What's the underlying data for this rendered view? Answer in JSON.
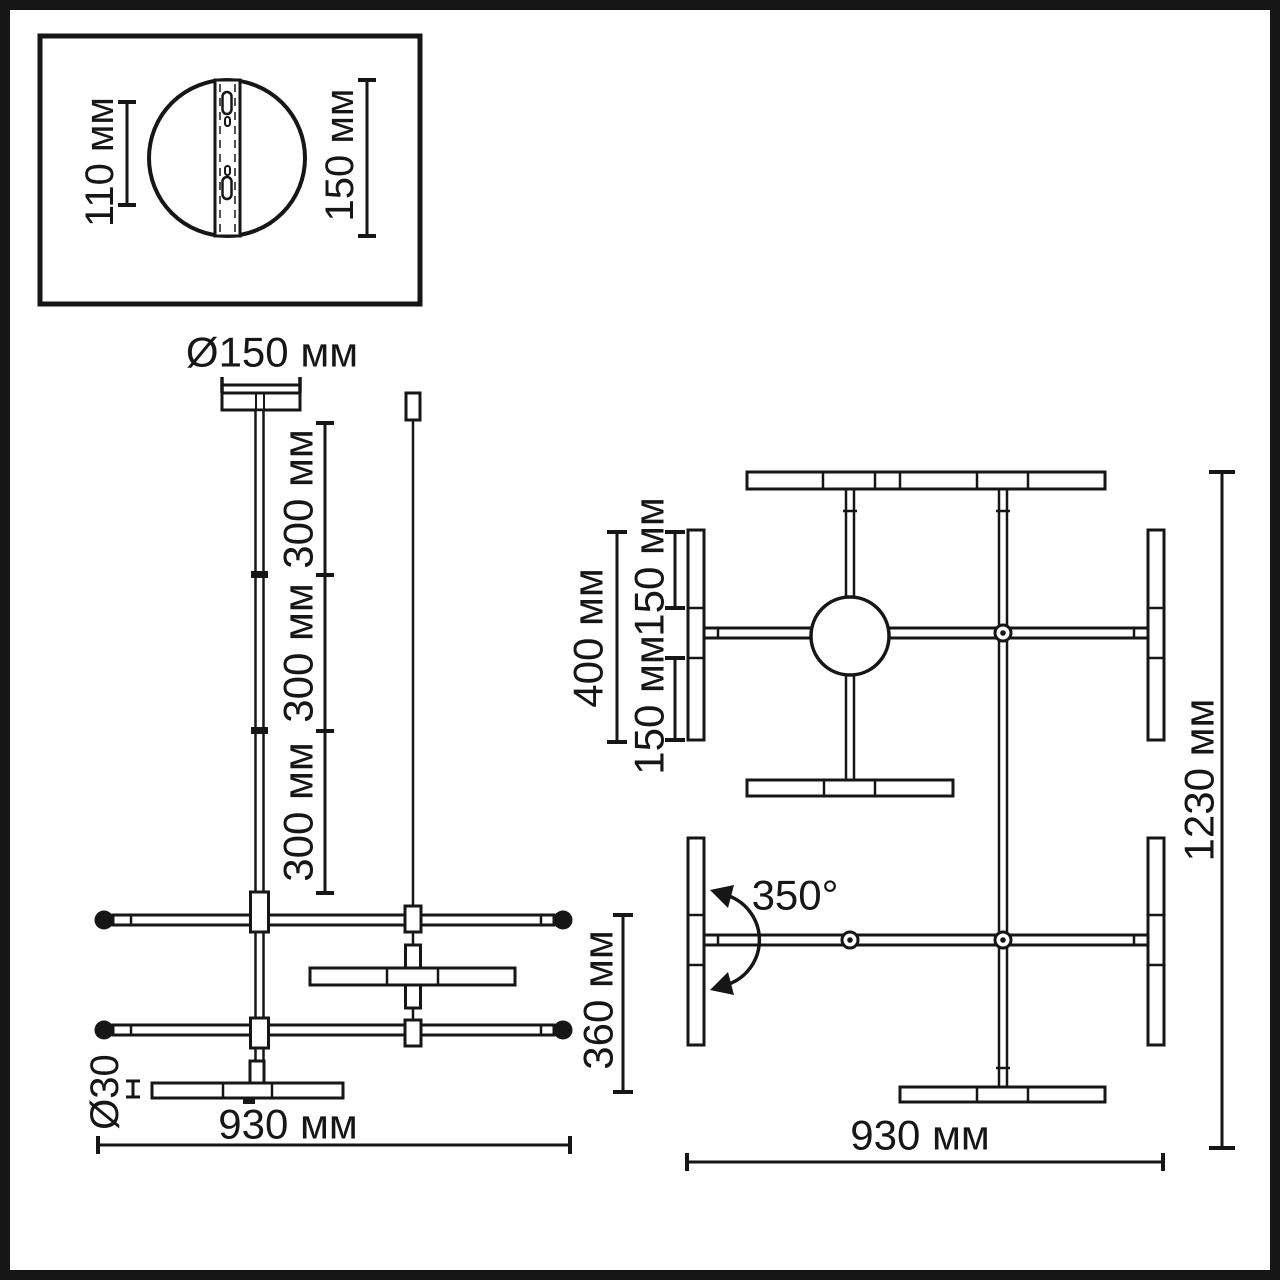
{
  "colors": {
    "line": "#161616",
    "background": "#ffffff"
  },
  "canopy_detail": {
    "height_label": "110 мм",
    "diameter_label": "150 мм"
  },
  "side_view": {
    "canopy_diameter": "Ø150 мм",
    "rod_sections": [
      "300 мм",
      "300 мм",
      "300 мм"
    ],
    "block_height": "360 мм",
    "tube_diameter": "Ø30",
    "width": "930 мм"
  },
  "top_view": {
    "lamp_length": "400 мм",
    "lamp_half_upper": "150 мм",
    "lamp_half_lower": "150 мм",
    "rotation_angle": "350°",
    "length": "1230 мм",
    "width": "930 мм"
  }
}
